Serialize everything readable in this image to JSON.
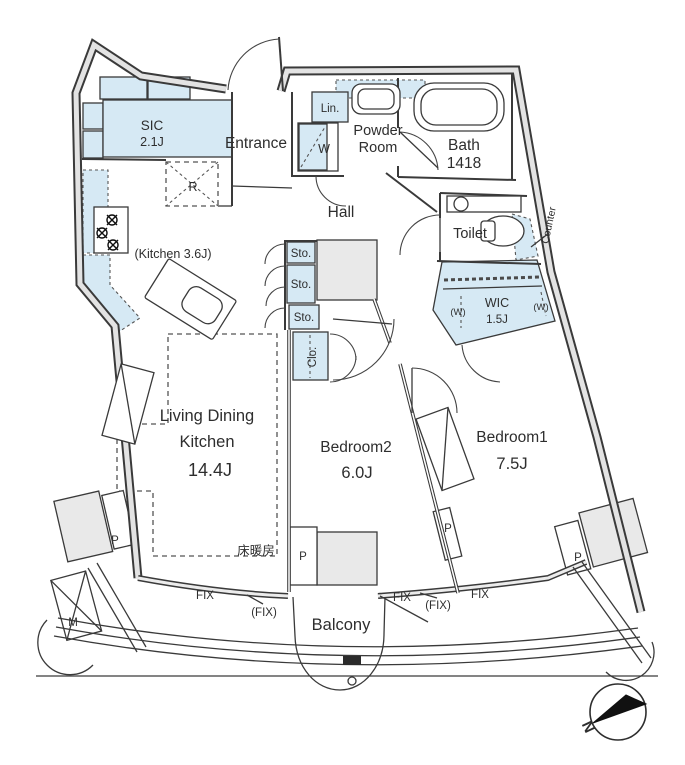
{
  "title": "apartment-floor-plan",
  "rooms": {
    "sic": {
      "name": "SIC",
      "size": "2.1J"
    },
    "entrance": {
      "name": "Entrance"
    },
    "powder_room": {
      "line1": "Powder",
      "line2": "Room"
    },
    "bath": {
      "name": "Bath",
      "size": "1418"
    },
    "hall": {
      "name": "Hall"
    },
    "toilet": {
      "name": "Toilet"
    },
    "kitchen": {
      "name": "(Kitchen 3.6J)"
    },
    "ldk": {
      "line1": "Living Dining",
      "line2": "Kitchen",
      "size": "14.4J"
    },
    "bedroom2": {
      "name": "Bedroom2",
      "size": "6.0J"
    },
    "bedroom1": {
      "name": "Bedroom1",
      "size": "7.5J"
    },
    "wic": {
      "name": "WIC",
      "size": "1.5J"
    },
    "balcony": {
      "name": "Balcony"
    }
  },
  "labels": {
    "linen": "Lin.",
    "washer": "W",
    "refrigerator": "R",
    "storage": "Sto.",
    "closet": "Clo.",
    "counter": "Counter",
    "floor_heating": "床暖房",
    "fix_window": "FIX",
    "fix_window_paren": "(FIX)",
    "pillar": "P",
    "meter": "M",
    "hanger_pipe": "(W)",
    "north": "N"
  },
  "colors": {
    "fixture_blue": "#d6e9f4",
    "wall_gray": "#e3e3e3",
    "pillar_gray": "#e9e9e9",
    "line": "#3a3a3a"
  }
}
